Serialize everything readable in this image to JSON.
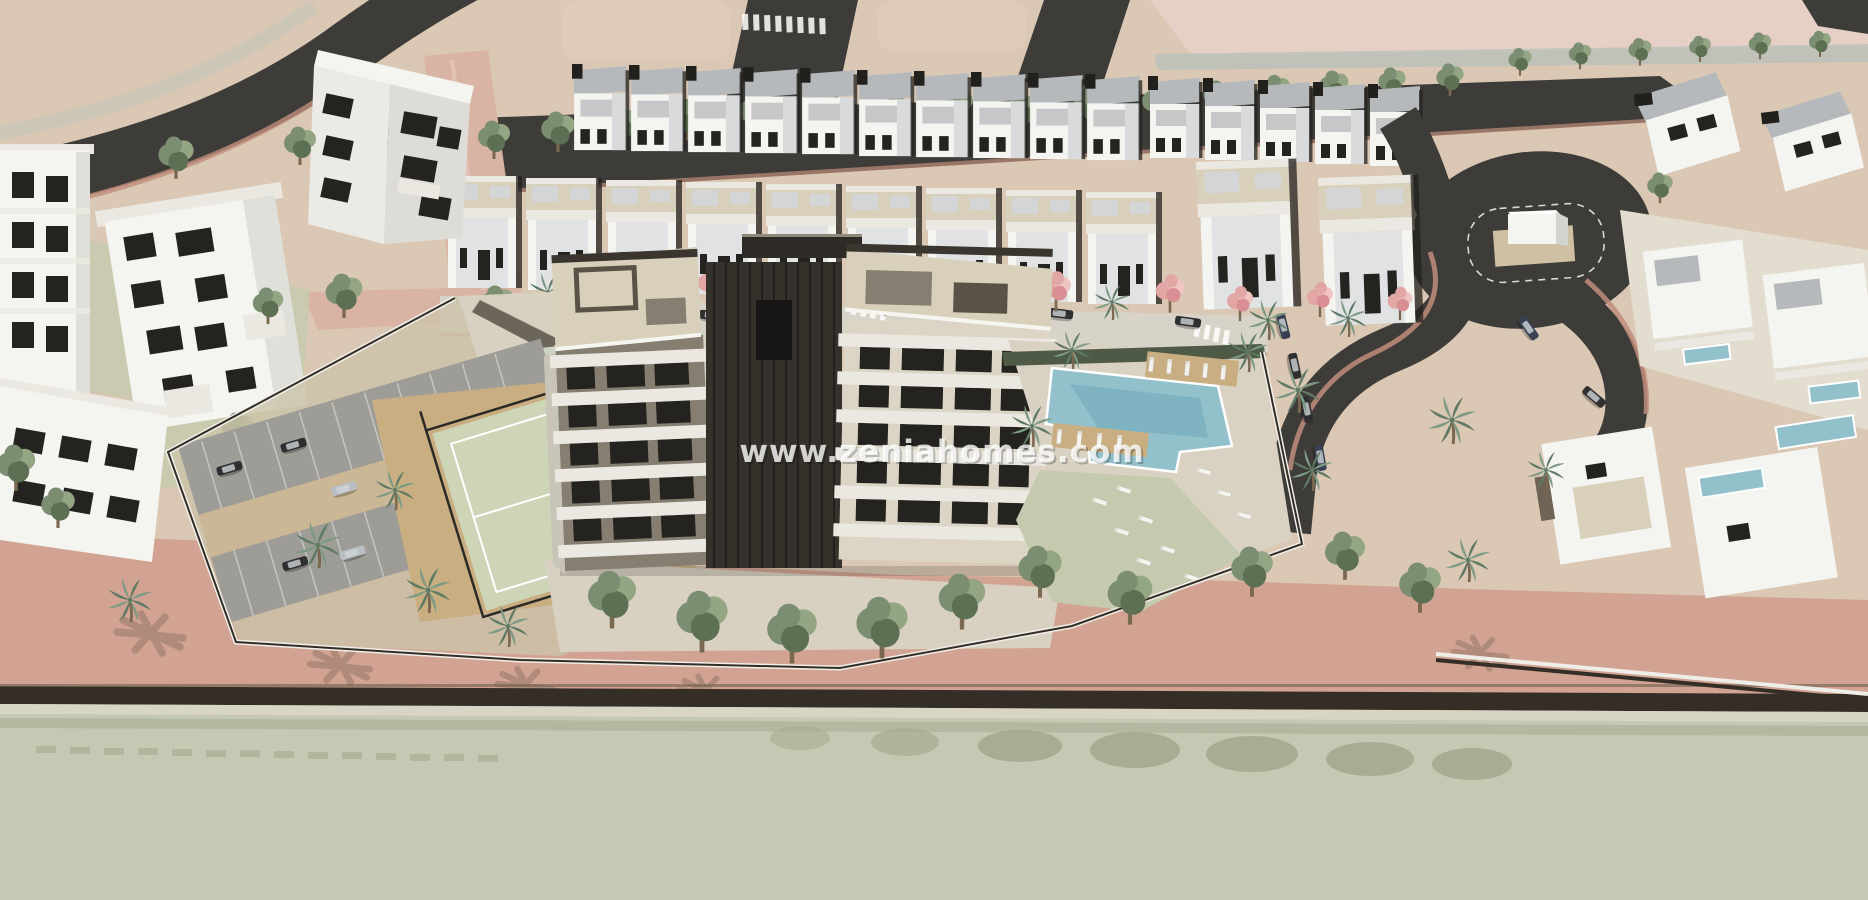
{
  "watermark": {
    "text": "www.zeniahomes.com"
  },
  "scene": {
    "type": "aerial-3d-architectural-render",
    "description": "Aerial 3D render of a new-build residential development: central apartment block with cream facades, white balcony bands and rooftop terraces, communal pool with sun loungers, lawn, padel court, playground and gated parking, surrounded by rows of white townhouses and villas, tree-lined streets, a roundabout and a promenade road along the bottom.",
    "features": [
      "central-apartment-building",
      "communal-pool",
      "sun-lounger-lawn",
      "padel-court",
      "playground",
      "gated-parking",
      "townhouse-rows",
      "white-villas",
      "tree-lined-street",
      "roundabout-with-sculpture",
      "promenade-road"
    ]
  },
  "palette": {
    "terrain": "#dac8b4",
    "terrainPink": "#e6d0c5",
    "plotPink": "#e1ccbd",
    "roadDark": "#3e3c38",
    "roadMedian": "#cbc6b6",
    "streetCream": "#d7d3c8",
    "salmon": "#d2a392",
    "salmonDeep": "#c08d7c",
    "salmonRoad": "#d9b4a4",
    "white": "#f4f4f1",
    "offWhite": "#eae8e1",
    "coolWhite": "#e0e2e4",
    "grayRoof": "#b6b9bc",
    "grayLight": "#d3d5d7",
    "grayMid": "#9ea2a5",
    "darkAccent": "#22201d",
    "windowDark": "#24231f",
    "taupe": "#877e72",
    "taupeDark": "#595247",
    "creamWall": "#dcd5c5",
    "creamRoof": "#d9d0bb",
    "coreDark": "#35312b",
    "green": "#7b8e71",
    "greenDark": "#5e7053",
    "treeHi": "#94a584",
    "trunk": "#7a6950",
    "pink": "#e2a6a5",
    "pinkHi": "#efc5c2",
    "palmGreen": "#7d9a84",
    "palmDark": "#5e7a65",
    "poolBlue": "#92c1cc",
    "poolDeep": "#6fa8b8",
    "lawn": "#c5caae",
    "court": "#ced5b7",
    "sand": "#c8ae81",
    "cobble": "#d8d1c1",
    "parkAsphalt": "#9d9c97",
    "parkLane": "#cbb795",
    "carDark": "#2f2e30",
    "carNavy": "#3a4054",
    "carSilver": "#b9bec5",
    "fenceDark": "#342e27",
    "hedge": "#4e5a46",
    "bottomRoad": "#c5c8b2",
    "roadShadow": "#a3a88d",
    "sidewalk": "#d9d5c5",
    "shadow": "#3c372d"
  }
}
